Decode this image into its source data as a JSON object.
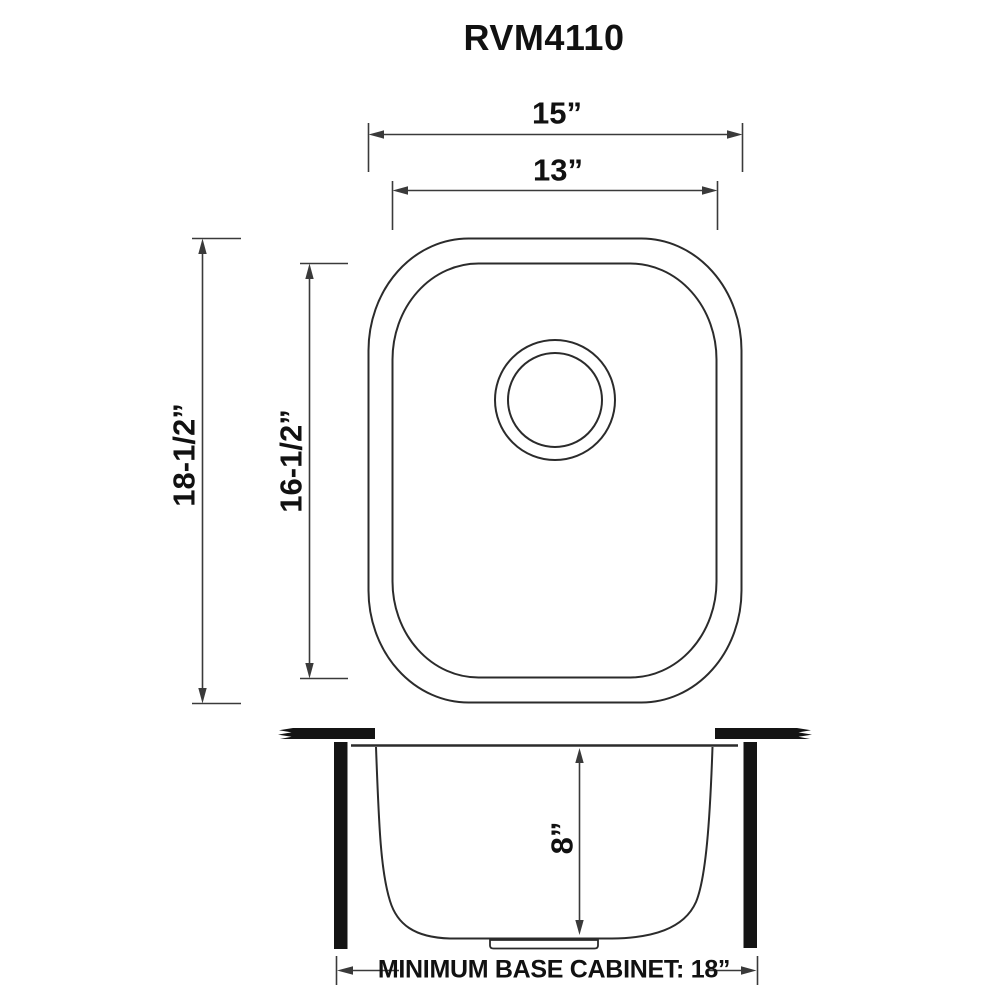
{
  "title": "RVM4110",
  "colors": {
    "background": "#ffffff",
    "line": "#3a3a3a",
    "outline": "#2b2b2b",
    "solid_fill": "#141414",
    "text": "#111111"
  },
  "top_view": {
    "outer_width_label": "15”",
    "inner_width_label": "13”",
    "outer_length_label": "18-1/2”",
    "inner_length_label": "16-1/2”"
  },
  "side_view": {
    "depth_label": "8”",
    "base_cabinet_label": "MINIMUM BASE CABINET: 18”"
  }
}
